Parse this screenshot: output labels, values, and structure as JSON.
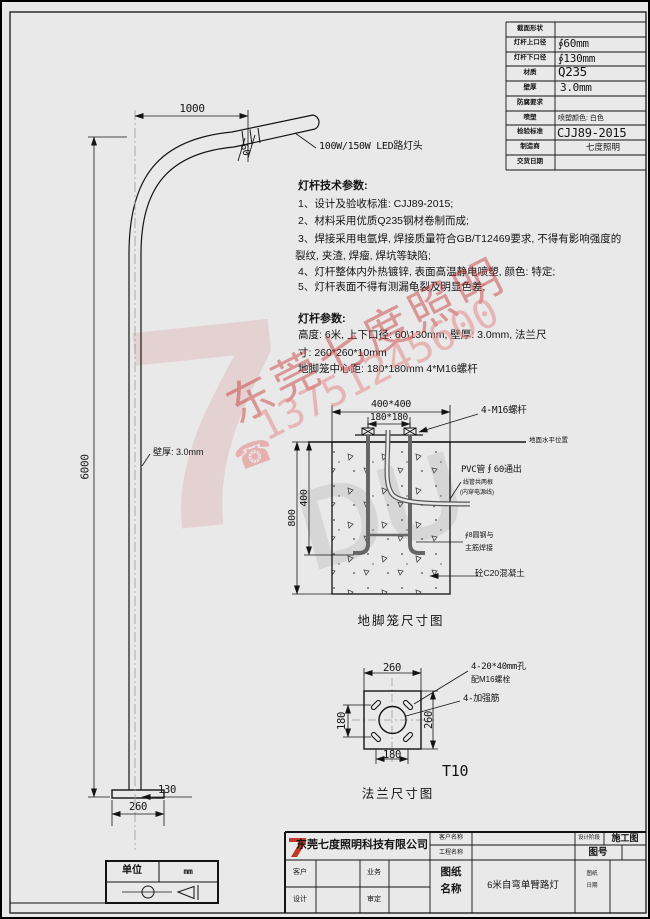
{
  "colors": {
    "paper": "#e9e9e9",
    "line": "#141414",
    "logo_red": "#c0392b",
    "watermark_pink": "#e8a0a0"
  },
  "spec_table": {
    "rows": [
      {
        "label": "截面形状",
        "value": ""
      },
      {
        "label": "灯杆上口径",
        "value": "∮60mm"
      },
      {
        "label": "灯杆下口径",
        "value": "∮130mm"
      },
      {
        "label": "材质",
        "value": "Q235"
      },
      {
        "label": "壁厚",
        "value": "3.0mm"
      },
      {
        "label": "防腐要求",
        "value": ""
      },
      {
        "label": "喷塑",
        "value": "喷塑颜色: 白色"
      },
      {
        "label": "检验标准",
        "value": "CJJ89-2015"
      },
      {
        "label": "制造商",
        "value": "七度照明"
      },
      {
        "label": "交货日期",
        "value": ""
      }
    ]
  },
  "pole": {
    "dim_arm_length": "1000",
    "dim_height": "6000",
    "dim_lamp_dia": "60",
    "dim_bottom_dia": "130",
    "dim_base_plate": "260",
    "lamp_label": "100W/150W LED路灯头",
    "wall_thickness_label": "壁厚: 3.0mm"
  },
  "tech_notes": {
    "title": "灯杆技术参数:",
    "lines": [
      "1、设计及验收标准: CJJ89-2015;",
      "2、材料采用优质Q235钢材卷制而成;",
      "3、焊接采用电氩焊, 焊接质量符合GB/T12469要求, 不得有影响强度的",
      "裂纹, 夹渣, 焊瘤, 焊坑等缺陷;",
      "4、灯杆整体内外热镀锌, 表面高温静电喷塑, 颜色: 特定;",
      "5、灯杆表面不得有测漏龟裂及明显色差;"
    ]
  },
  "pole_params": {
    "title": "灯杆参数:",
    "lines": [
      "高度: 6米, 上下口径: 60\\130mm, 壁厚: 3.0mm, 法兰尺",
      "寸: 260*260*10mm",
      "地脚笼中心距: 180*180mm  4*M16螺杆"
    ]
  },
  "foundation": {
    "caption": "地脚笼尺寸图",
    "dim_top_outer": "400*400",
    "dim_top_inner": "180*180",
    "anchor_label": "4-M16螺杆",
    "ground_label": "地面水平位置",
    "dim_depth_inner": "400",
    "dim_depth_outer": "800",
    "pvc_label_1": "PVC管∮60通出",
    "pvc_label_2": "线管共两根",
    "pvc_label_3": "(内穿电源线)",
    "rebar_label_1": "∮8圆钢与",
    "rebar_label_2": "主筋焊接",
    "concrete_label": "砼C20混凝土"
  },
  "flange": {
    "caption": "法兰尺寸图",
    "dim_width_top": "260",
    "dim_holes_h": "180",
    "dim_holes_v": "180",
    "dim_width_right": "260",
    "holes_label_1": "4-20*40mm孔",
    "holes_label_2": "配M16螺栓",
    "rib_label": "4-加强筋",
    "thickness_label": "T10"
  },
  "units_box": {
    "label": "单位",
    "value": "mm"
  },
  "title_block": {
    "company": "东莞七度照明科技有限公司",
    "logo_text": "7",
    "client_name_label": "客户名称",
    "project_name_label": "工程名称",
    "design_stage_label": "设计阶段",
    "design_stage_value": "施工图",
    "drawing_no_label": "图号",
    "client_label": "客户",
    "business_label": "业务",
    "design_label": "设计",
    "review_label": "审定",
    "drawing_name_label_1": "图纸",
    "drawing_name_label_2": "名称",
    "drawing_name_value": "6米自弯单臂路灯",
    "drawing_date_label_1": "图纸",
    "drawing_date_label_2": "日期"
  },
  "watermark": {
    "logo_7": "7",
    "logo_du": "DU",
    "company": "东莞七度照明",
    "phone": "13751245600",
    "phone_icon": "☎"
  }
}
